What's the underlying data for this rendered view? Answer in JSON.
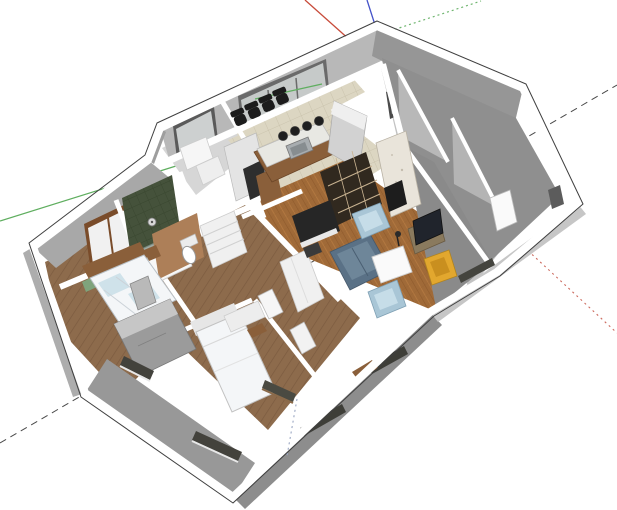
{
  "scene": {
    "kind": "3d-architectural-model",
    "description": "SketchUp-style cutaway dollhouse view of an apartment floor plan with furniture",
    "background": "#ffffff"
  },
  "axes": {
    "green_solid": {
      "color": "#5fae5f"
    },
    "green_dotted": {
      "color": "#6fb56f"
    },
    "red_solid": {
      "color": "#c84b3a"
    },
    "red_dotted": {
      "color": "#cc6a5e"
    },
    "blue_solid": {
      "color": "#4553c9"
    },
    "blue_dotted": {
      "color": "#9aa6c2"
    },
    "hidden_guide": {
      "color": "#4a4a4a"
    }
  },
  "palette": {
    "wall_cut_top": "#ffffff",
    "wall_outline": "#3f3f3f",
    "wall_outer_dark": "#8f8f8f",
    "wall_outer_mid": "#9e9e9e",
    "wall_inner_light": "#b8b8b8",
    "wall_inner_back": "#a8a8a8",
    "wing_floor": "#c2c2c2",
    "upper_room_floor": "#d6d6d6",
    "floor_wood": "#8d6b4c",
    "floor_parquet": "#a06a38",
    "floor_tile": "#dcd6c2",
    "bath_green": "#45523b",
    "wood_accent": "#8a5f3a",
    "sofa_blue": "#5a7186",
    "sofa_cushion": "#6e8699",
    "armchair_blue": "#a9c6d6",
    "armchair_inner": "#c6dde8",
    "chair_yellow": "#e2a72e",
    "coffee_table": "#fafafa",
    "piano_black": "#262626",
    "office_chair": "#1c1c1c",
    "stool_dark": "#1f1f1f",
    "fireplace_marble": "#e9e4da",
    "firebox": "#1d1d1d",
    "bed_white": "#f4f6f8",
    "bed_accent_blue": "#cfe2ea",
    "wardrobe_gray": "#9b9b9b",
    "cabinet_white": "#f0f0f0",
    "brown_wall": "#ad7f58",
    "tv_dark": "#20242c",
    "window_slit": "#43423c",
    "window_pane": "#c6cac9",
    "shelving_dark": "#31291f",
    "island_top": "#e8e8e3",
    "sink_steel": "#a8adb0"
  }
}
